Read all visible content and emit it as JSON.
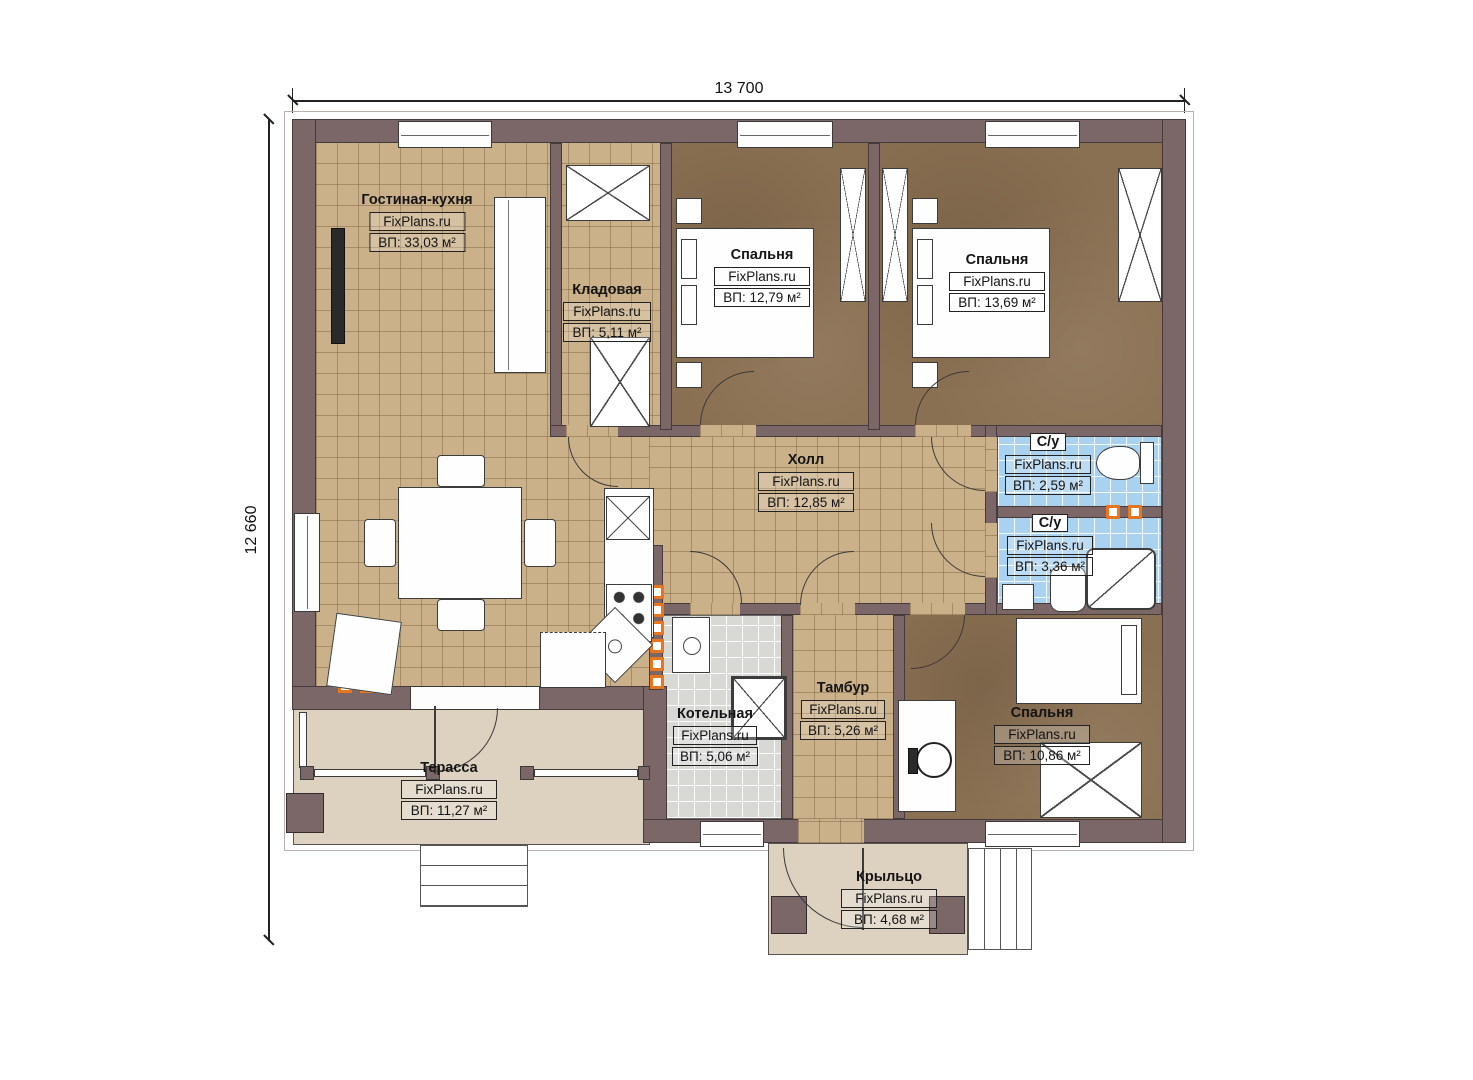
{
  "brand": "FixPlans.ru",
  "dimensions": {
    "width": "13 700",
    "height": "12 660"
  },
  "rooms": [
    {
      "id": "living",
      "name": "Гостиная-кухня",
      "area": "ВП: 33,03 м²"
    },
    {
      "id": "storage",
      "name": "Кладовая",
      "area": "ВП: 5,11 м²"
    },
    {
      "id": "bedroom1",
      "name": "Спальня",
      "area": "ВП: 12,79 м²"
    },
    {
      "id": "bedroom2",
      "name": "Спальня",
      "area": "ВП: 13,69 м²"
    },
    {
      "id": "hall",
      "name": "Холл",
      "area": "ВП: 12,85 м²"
    },
    {
      "id": "wc1",
      "name": "С/у",
      "area": "ВП: 2,59 м²"
    },
    {
      "id": "wc2",
      "name": "С/у",
      "area": "ВП: 3,36 м²"
    },
    {
      "id": "boiler",
      "name": "Котельная",
      "area": "ВП: 5,06 м²"
    },
    {
      "id": "tambour",
      "name": "Тамбур",
      "area": "ВП: 5,26 м²"
    },
    {
      "id": "bedroom3",
      "name": "Спальня",
      "area": "ВП: 10,86 м²"
    },
    {
      "id": "terrace",
      "name": "Терасса",
      "area": "ВП: 11,27 м²"
    },
    {
      "id": "porch",
      "name": "Крыльцо",
      "area": "ВП: 4,68 м²"
    }
  ],
  "colors": {
    "wall": "#7b6767",
    "floor_tan": "#cbb189",
    "floor_brown": "#8a7052",
    "floor_blue": "#a9d2f1",
    "floor_gray": "#d8d8d5",
    "floor_beige": "#ddd2c0",
    "vent_orange": "#e8761f",
    "line": "#3a3a3a"
  }
}
